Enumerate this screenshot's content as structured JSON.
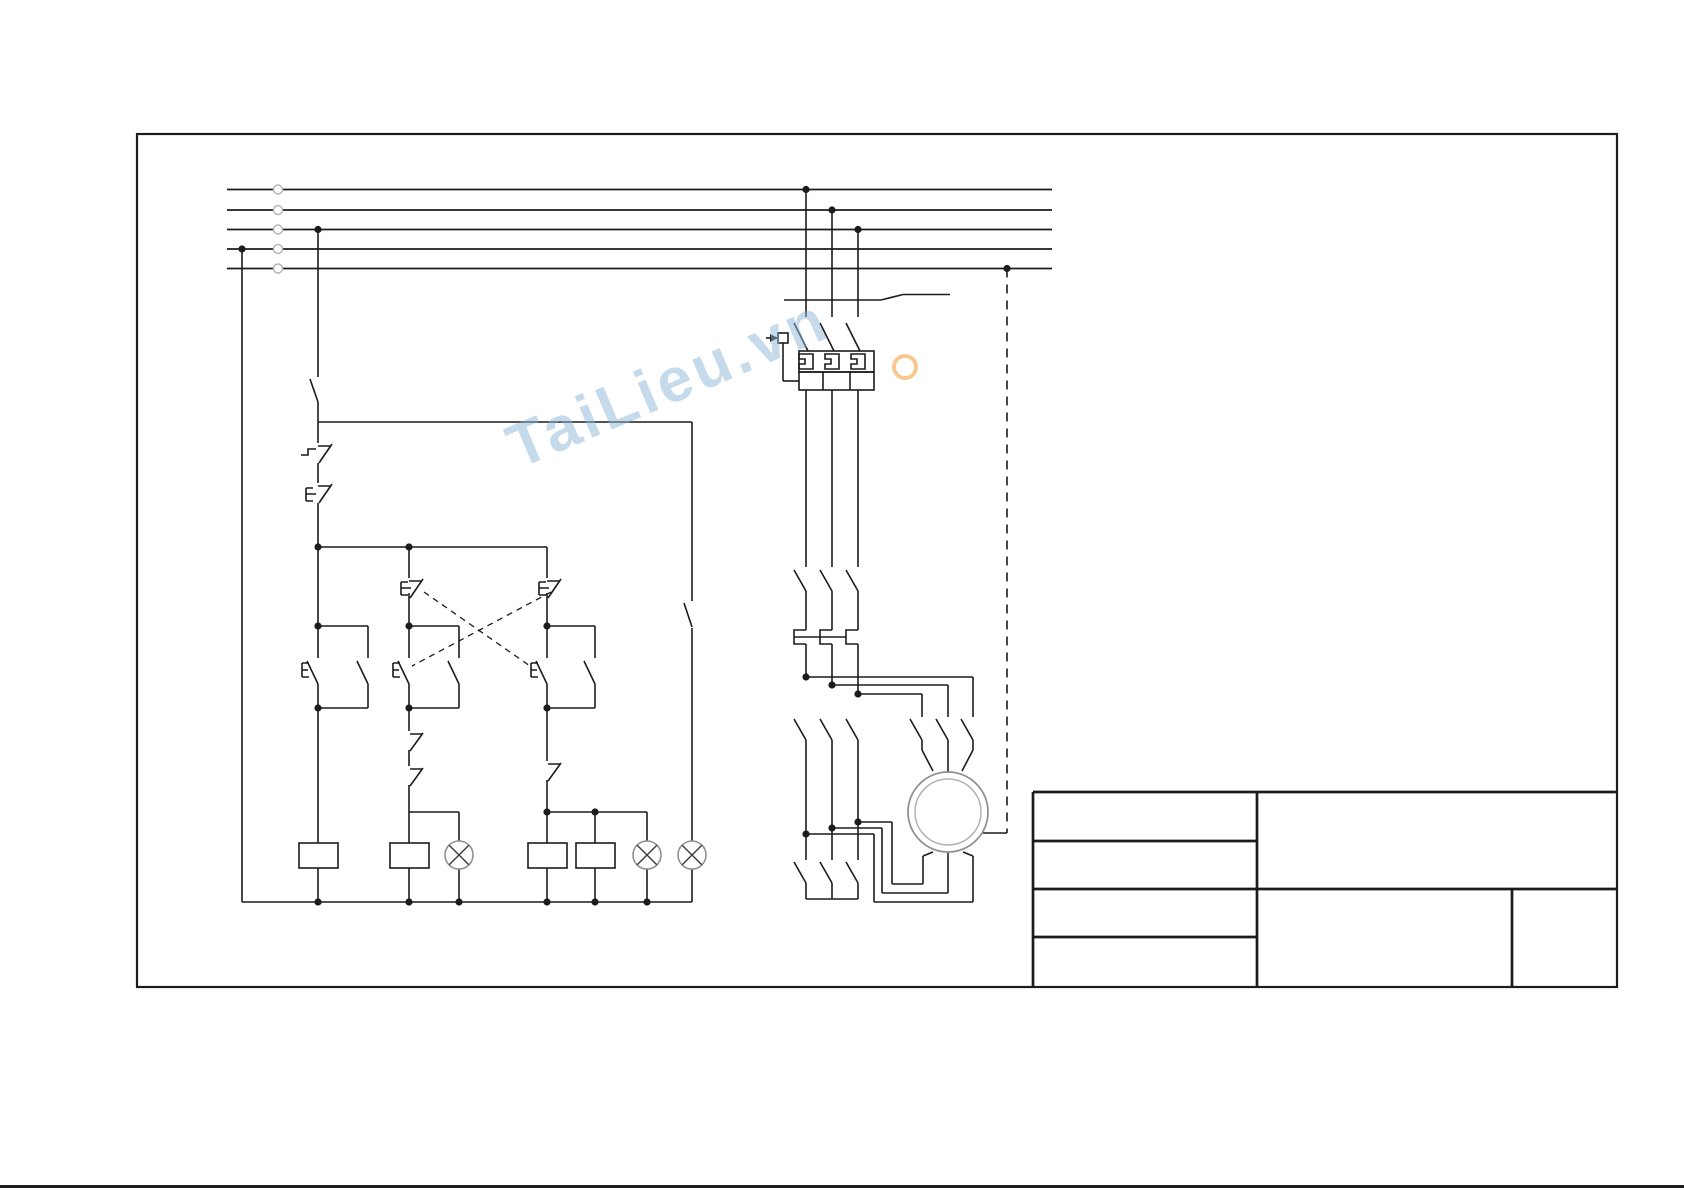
{
  "watermark": {
    "text": "TaiLieu.vn",
    "color": "rgba(140,181,216,0.5)",
    "accent_color": "#f09d35",
    "accent_ring": [
      905,
      367,
      11
    ]
  },
  "page": {
    "background": "#ffffff",
    "bottom_rule": [
      0,
      1186.5,
      1684,
      1186.5
    ]
  },
  "schematic": {
    "ink": "#1c1c1c",
    "light_gray": "#8f8f8f",
    "mid_gray": "#b3b3b3",
    "border": {
      "x": 137,
      "y": 134,
      "w": 1480,
      "h": 853
    },
    "bus_lines": [
      [
        227,
        189.5,
        1052,
        189.5
      ],
      [
        227,
        210,
        1052,
        210
      ],
      [
        227,
        229.5,
        1052,
        229.5
      ],
      [
        227,
        249,
        1052,
        249
      ],
      [
        227,
        268.5,
        1052,
        268.5
      ]
    ],
    "bus_terminals": [
      [
        278,
        189.5
      ],
      [
        278,
        210
      ],
      [
        278,
        229.5
      ],
      [
        278,
        249
      ],
      [
        278,
        268.5
      ]
    ],
    "bus_terminal_radius": 4.5,
    "wires": [
      [
        242,
        249,
        242,
        902
      ],
      [
        242,
        902,
        692,
        902
      ],
      [
        318,
        229.5,
        318,
        377
      ],
      [
        318,
        402,
        318,
        443
      ],
      [
        318,
        463,
        318,
        483
      ],
      [
        318,
        503,
        318,
        658
      ],
      [
        318,
        684,
        318,
        708
      ],
      [
        318,
        708,
        318,
        843
      ],
      [
        318,
        868,
        318,
        902
      ],
      [
        318,
        422,
        692,
        422
      ],
      [
        692,
        422,
        692,
        601
      ],
      [
        692,
        628,
        692,
        841
      ],
      [
        692,
        869,
        692,
        902
      ],
      [
        318,
        547,
        547,
        547
      ],
      [
        318,
        626,
        368,
        626
      ],
      [
        368,
        626,
        368,
        658
      ],
      [
        368,
        684,
        368,
        708
      ],
      [
        368,
        708,
        318,
        708
      ],
      [
        409,
        547,
        409,
        578
      ],
      [
        409,
        593,
        409,
        658
      ],
      [
        409,
        684,
        409,
        731
      ],
      [
        409,
        750,
        409,
        766
      ],
      [
        409,
        785,
        409,
        843
      ],
      [
        409,
        868,
        409,
        902
      ],
      [
        409,
        626,
        459,
        626
      ],
      [
        459,
        626,
        459,
        658
      ],
      [
        459,
        684,
        459,
        708
      ],
      [
        459,
        708,
        409,
        708
      ],
      [
        409,
        812,
        459,
        812
      ],
      [
        459,
        812,
        459,
        841
      ],
      [
        459,
        869,
        459,
        902
      ],
      [
        547,
        547,
        547,
        578
      ],
      [
        547,
        593,
        547,
        658
      ],
      [
        547,
        684,
        547,
        708
      ],
      [
        547,
        708,
        547,
        761
      ],
      [
        547,
        780,
        547,
        843
      ],
      [
        547,
        868,
        547,
        902
      ],
      [
        547,
        626,
        595,
        626
      ],
      [
        595,
        626,
        595,
        658
      ],
      [
        595,
        684,
        595,
        708
      ],
      [
        595,
        708,
        547,
        708
      ],
      [
        547,
        812,
        647,
        812
      ],
      [
        595,
        812,
        595,
        843
      ],
      [
        595,
        868,
        595,
        902
      ],
      [
        647,
        812,
        647,
        841
      ],
      [
        647,
        869,
        647,
        902
      ],
      [
        806,
        189.5,
        806,
        317
      ],
      [
        832,
        210,
        832,
        317
      ],
      [
        858,
        229.5,
        858,
        317
      ],
      [
        784,
        300,
        881,
        300
      ],
      [
        881,
        300,
        903,
        294.5
      ],
      [
        903,
        294.5,
        950,
        294.5
      ],
      [
        766,
        338,
        778,
        338
      ],
      [
        783,
        343,
        783,
        381
      ],
      [
        783,
        381,
        799,
        381
      ],
      [
        806,
        390,
        806,
        567
      ],
      [
        832,
        390,
        832,
        567
      ],
      [
        858,
        390,
        858,
        567
      ],
      [
        806,
        591,
        806,
        630
      ],
      [
        832,
        591,
        832,
        630
      ],
      [
        858,
        591,
        858,
        630
      ],
      [
        794,
        637,
        846,
        637
      ],
      [
        806,
        644,
        806,
        677
      ],
      [
        832,
        644,
        832,
        685
      ],
      [
        858,
        644,
        858,
        694
      ],
      [
        806,
        677,
        973,
        677
      ],
      [
        973,
        677,
        973,
        717
      ],
      [
        832,
        685,
        948,
        685
      ],
      [
        948,
        685,
        948,
        717
      ],
      [
        858,
        694,
        922,
        694
      ],
      [
        922,
        694,
        922,
        717
      ],
      [
        922,
        740,
        922,
        750
      ],
      [
        922,
        750,
        933,
        771
      ],
      [
        948,
        740,
        948,
        772
      ],
      [
        973,
        740,
        973,
        750
      ],
      [
        973,
        750,
        962,
        771
      ],
      [
        806,
        740,
        806,
        860
      ],
      [
        832,
        740,
        832,
        860
      ],
      [
        858,
        740,
        858,
        860
      ],
      [
        806,
        883,
        806,
        899
      ],
      [
        832,
        883,
        832,
        899
      ],
      [
        858,
        883,
        858,
        899
      ],
      [
        806,
        899,
        858,
        899
      ],
      [
        858,
        822,
        892,
        822
      ],
      [
        892,
        822,
        892,
        884
      ],
      [
        892,
        884,
        923,
        884
      ],
      [
        923,
        884,
        923,
        856
      ],
      [
        923,
        856,
        933,
        852
      ],
      [
        832,
        828,
        882,
        828
      ],
      [
        882,
        828,
        882,
        893
      ],
      [
        882,
        893,
        948,
        893
      ],
      [
        948,
        893,
        948,
        853
      ],
      [
        806,
        834,
        874,
        834
      ],
      [
        874,
        834,
        874,
        902
      ],
      [
        874,
        902,
        973,
        902
      ],
      [
        973,
        902,
        973,
        856
      ],
      [
        973,
        856,
        963,
        852
      ],
      [
        983,
        833,
        1007,
        833
      ]
    ],
    "dashed_pe_wire": [
      1007,
      268.5,
      1007,
      833
    ],
    "dashed_interlock_links": [
      [
        424,
        592,
        530,
        666
      ],
      [
        551,
        592,
        412,
        666
      ]
    ],
    "junction_dots": [
      [
        318,
        229.5
      ],
      [
        242,
        249
      ],
      [
        806,
        189.5
      ],
      [
        832,
        210
      ],
      [
        858,
        229.5
      ],
      [
        1007,
        268.5
      ],
      [
        318,
        547
      ],
      [
        409,
        547
      ],
      [
        318,
        626
      ],
      [
        409,
        626
      ],
      [
        547,
        626
      ],
      [
        318,
        708
      ],
      [
        409,
        708
      ],
      [
        547,
        708
      ],
      [
        547,
        812
      ],
      [
        595,
        812
      ],
      [
        318,
        902
      ],
      [
        409,
        902
      ],
      [
        459,
        902
      ],
      [
        547,
        902
      ],
      [
        595,
        902
      ],
      [
        647,
        902
      ],
      [
        806,
        677
      ],
      [
        832,
        685
      ],
      [
        858,
        694
      ],
      [
        858,
        822
      ],
      [
        832,
        828
      ],
      [
        806,
        834
      ]
    ],
    "symbol_paths": [
      {
        "name": "control-knife-switch-blade",
        "d": "M310,379 L318,402"
      },
      {
        "name": "lamp-branch-switch-blade",
        "d": "M684,603 L692,627"
      },
      {
        "name": "thermal-nc-contact",
        "d": "M318,446 L331,446 M319,463 L332,444 M316,449 L308,449 L308,455 L301,455"
      },
      {
        "name": "stop-button-nc-contact",
        "d": "M318,486 L331,486 M319,503 L332,484 M306,488 L306,501 M306,488 L313,488 M306,501 L313,501 M306,494 L316,494"
      },
      {
        "name": "interlock-nc-contact-1",
        "d": "M409,581 L421,581 M410,598 L423,579 M401,582 L401,595 M401,582 L408,582 M401,595 L408,595 M401,588 L411,588"
      },
      {
        "name": "interlock-nc-contact-2",
        "d": "M547,581 L559,581 M548,598 L561,579 M539,582 L539,595 M539,582 L546,582 M539,595 L546,595 M539,588 L549,588"
      },
      {
        "name": "start-button-1",
        "d": "M307,661 L318,684 M302,663 L302,677 M302,663 L309,663 M302,677 L309,677 M302,670 L308,670"
      },
      {
        "name": "holding-contact-1",
        "d": "M357,661 L368,684"
      },
      {
        "name": "start-button-2",
        "d": "M398,661 L409,684 M393,663 L393,677 M393,663 L400,663 M393,677 L400,677 M393,670 L399,670"
      },
      {
        "name": "holding-contact-2",
        "d": "M448,661 L459,684"
      },
      {
        "name": "start-button-3",
        "d": "M536,661 L547,684 M531,663 L531,677 M531,663 L538,663 M531,677 L538,677 M531,670 L537,670"
      },
      {
        "name": "holding-contact-3",
        "d": "M584,661 L595,684"
      },
      {
        "name": "aux-nc-contact-1",
        "d": "M410,734 L422,734 M410,751 L423,733"
      },
      {
        "name": "aux-nc-contact-2",
        "d": "M410,769 L422,769 M410,786 L423,768"
      },
      {
        "name": "aux-nc-contact-3",
        "d": "M548,764 L560,764 M548,781 L561,763"
      },
      {
        "name": "breaker-pole-blade-1",
        "d": "M794,323 L808,351"
      },
      {
        "name": "breaker-pole-blade-2",
        "d": "M820,323 L834,351"
      },
      {
        "name": "breaker-pole-blade-3",
        "d": "M846,323 L860,351"
      },
      {
        "name": "breaker-latch-1",
        "d": "M799,354 L813,354 L813,369 L799,369 L799,364 L805,364 L805,359 L799,359 Z"
      },
      {
        "name": "breaker-latch-2",
        "d": "M825,354 L839,354 L839,369 L825,369 L825,364 L831,364 L831,359 L825,359 Z"
      },
      {
        "name": "breaker-latch-3",
        "d": "M851,354 L865,354 L865,369 L851,369 L851,364 L857,364 L857,359 L851,359 Z"
      },
      {
        "name": "main-contactor-blade-1",
        "d": "M794,570 L806,591"
      },
      {
        "name": "main-contactor-blade-2",
        "d": "M820,570 L832,591"
      },
      {
        "name": "main-contactor-blade-3",
        "d": "M846,570 L858,591"
      },
      {
        "name": "overload-heater-1",
        "d": "M806,630 L794,630 L794,644 L806,644"
      },
      {
        "name": "overload-heater-2",
        "d": "M832,630 L820,630 L820,644 L832,644"
      },
      {
        "name": "overload-heater-3",
        "d": "M858,630 L846,630 L846,644 L858,644"
      },
      {
        "name": "speed2-contactor-blade-1",
        "d": "M910,719 L922,740"
      },
      {
        "name": "speed2-contactor-blade-2",
        "d": "M936,719 L948,740"
      },
      {
        "name": "speed2-contactor-blade-3",
        "d": "M961,719 L973,740"
      },
      {
        "name": "speed1-contactor-blade-1",
        "d": "M794,719 L806,740"
      },
      {
        "name": "speed1-contactor-blade-2",
        "d": "M820,719 L832,740"
      },
      {
        "name": "speed1-contactor-blade-3",
        "d": "M846,719 L858,740"
      },
      {
        "name": "star-contactor-blade-1",
        "d": "M794,862 L806,883"
      },
      {
        "name": "star-contactor-blade-2",
        "d": "M820,862 L832,883"
      },
      {
        "name": "star-contactor-blade-3",
        "d": "M846,862 L858,883"
      }
    ],
    "breaker": {
      "upper_body": [
        799,
        351,
        75,
        21
      ],
      "lower_body": [
        799,
        372,
        75,
        18
      ],
      "lower_dividers": [
        [
          823,
          372,
          823,
          390
        ],
        [
          850,
          372,
          850,
          390
        ]
      ],
      "trip_button": [
        778,
        333,
        10,
        10
      ],
      "trip_arrow": "M770,334 L770,342 L778,338 Z"
    },
    "coils": [
      {
        "name": "contactor-coil-1",
        "x": 299,
        "y": 843,
        "w": 39,
        "h": 25
      },
      {
        "name": "contactor-coil-2",
        "x": 390,
        "y": 843,
        "w": 39,
        "h": 25
      },
      {
        "name": "contactor-coil-3",
        "x": 528,
        "y": 843,
        "w": 39,
        "h": 25
      },
      {
        "name": "contactor-coil-4",
        "x": 576,
        "y": 843,
        "w": 39,
        "h": 25
      }
    ],
    "lamps": [
      {
        "name": "indicator-lamp-1",
        "cx": 459,
        "cy": 855,
        "r": 14
      },
      {
        "name": "indicator-lamp-2",
        "cx": 647,
        "cy": 855,
        "r": 14
      },
      {
        "name": "indicator-lamp-3",
        "cx": 692,
        "cy": 855,
        "r": 14
      }
    ],
    "motor": {
      "cx": 948,
      "cy": 812,
      "r_outer": 40,
      "r_inner": 33
    },
    "title_block_lines": [
      [
        1033,
        792,
        1617,
        792
      ],
      [
        1033,
        792,
        1033,
        987
      ],
      [
        1257,
        792,
        1257,
        987
      ],
      [
        1033,
        841,
        1257,
        841
      ],
      [
        1033,
        889,
        1617,
        889
      ],
      [
        1033,
        937,
        1257,
        937
      ],
      [
        1512,
        889,
        1512,
        987
      ]
    ]
  }
}
